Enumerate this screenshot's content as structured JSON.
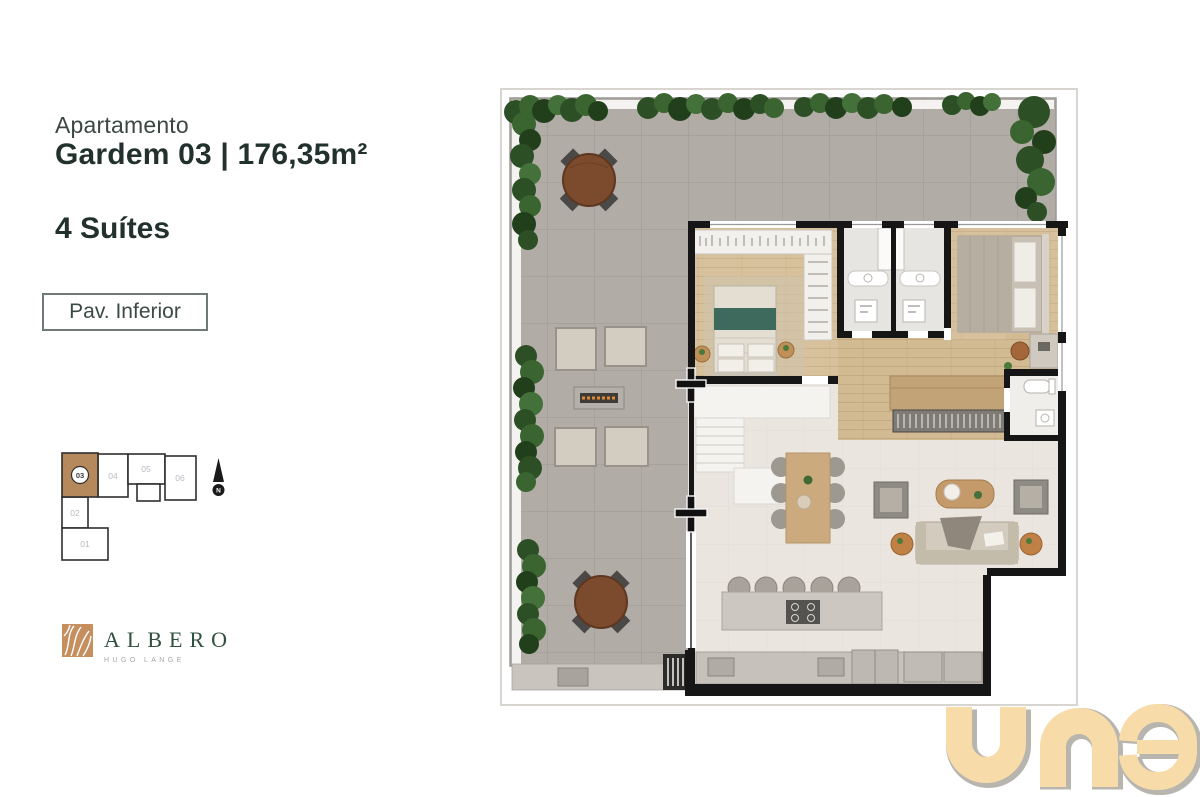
{
  "header": {
    "label": "Apartamento",
    "title": "Gardem 03 | 176,35m²",
    "suites": "4 Suítes",
    "badge": "Pav. Inferior"
  },
  "keyplan": {
    "highlight_color": "#b5895c",
    "highlighted_unit": "03",
    "units": [
      {
        "id": "03",
        "highlighted": true
      },
      {
        "id": "04",
        "highlighted": false
      },
      {
        "id": "05",
        "highlighted": false
      },
      {
        "id": "06",
        "highlighted": false
      },
      {
        "id": "02",
        "highlighted": false
      },
      {
        "id": "01",
        "highlighted": false
      }
    ],
    "compass_letter": "N"
  },
  "brand": {
    "name": "ALBERO",
    "subtitle": "HUGO LANGE"
  },
  "watermark": {
    "text": "una",
    "fill": "#f7dcaa",
    "outline": "#b8b4ae"
  },
  "floorplan": {
    "colors": {
      "terrace_tile": "#b1aca6",
      "interior_floor": "#eae6df",
      "wood_floor": "#d7c19c",
      "wall": "#161616",
      "hedge_green": "#2c4f25",
      "bed_accent_teal": "#3e6a5d",
      "outdoor_table_wood": "#7c4a2c"
    },
    "features": [
      "terrace",
      "hedges",
      "outdoor-dining-tables",
      "fire-pit-lounge",
      "suite-1",
      "suite-2",
      "twin-bathrooms",
      "walk-in-closet",
      "stairs",
      "corridor",
      "living-room",
      "dining-table",
      "sofa-set",
      "buffet-glass-rack",
      "kitchen-island",
      "kitchen-counter",
      "grill",
      "suite-2-bathroom"
    ]
  }
}
